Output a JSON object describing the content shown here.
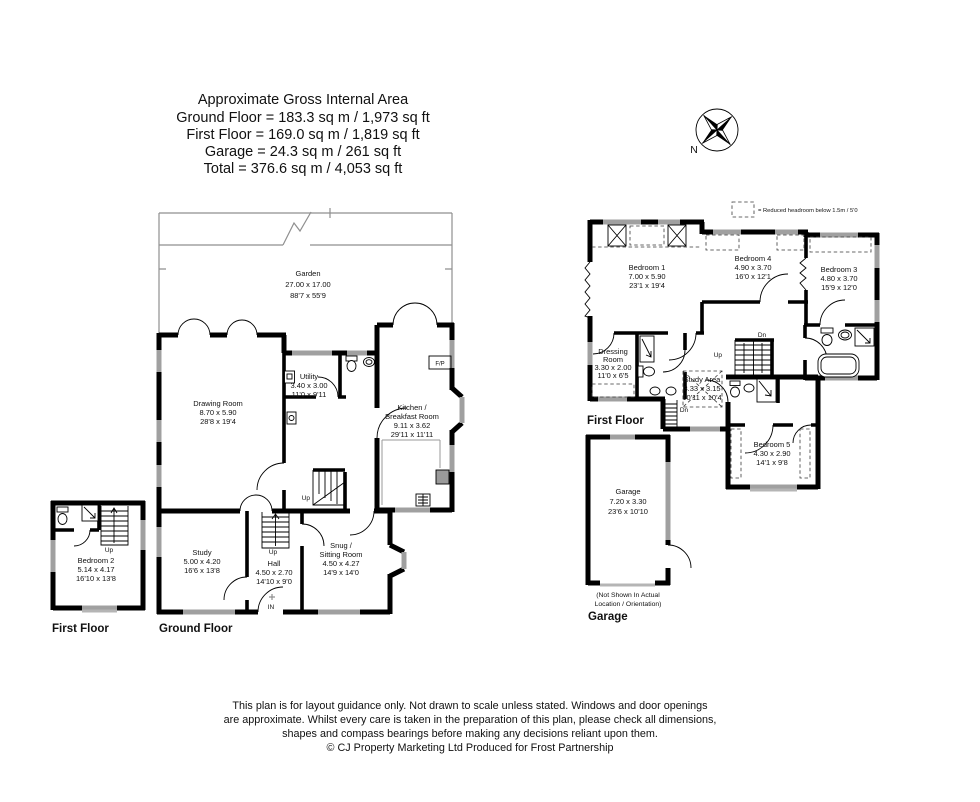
{
  "header": {
    "title": "Approximate Gross Internal Area",
    "lines": [
      "Ground Floor = 183.3 sq m / 1,973 sq ft",
      "First Floor = 169.0 sq m / 1,819 sq ft",
      "Garage = 24.3 sq m / 261 sq ft",
      "Total = 376.6 sq m / 4,053 sq ft"
    ]
  },
  "compass": {
    "north_label": "N"
  },
  "legend": {
    "note": "= Reduced headroom below 1.5m / 5'0"
  },
  "rooms": {
    "garden": {
      "name": "Garden",
      "metric": "27.00 x 17.00",
      "imperial": "88'7 x 55'9"
    },
    "drawing_room": {
      "name": "Drawing Room",
      "metric": "8.70 x 5.90",
      "imperial": "28'8 x 19'4"
    },
    "utility": {
      "name": "Utility",
      "metric": "3.40 x 3.00",
      "imperial": "11'0 x 9'11"
    },
    "kitchen": {
      "name1": "Kitchen /",
      "name2": "Breakfast Room",
      "metric": "9.11 x 3.62",
      "imperial": "29'11 x 11'11"
    },
    "study": {
      "name": "Study",
      "metric": "5.00 x 4.20",
      "imperial": "16'6 x 13'8"
    },
    "hall": {
      "name": "Hall",
      "metric": "4.50 x 2.70",
      "imperial": "14'10 x 9'0"
    },
    "snug": {
      "name1": "Snug /",
      "name2": "Sitting Room",
      "metric": "4.50 x 4.27",
      "imperial": "14'9 x 14'0"
    },
    "bedroom2": {
      "name": "Bedroom 2",
      "metric": "5.14 x 4.17",
      "imperial": "16'10 x 13'8"
    },
    "bedroom1": {
      "name": "Bedroom 1",
      "metric": "7.00 x 5.90",
      "imperial": "23'1 x 19'4"
    },
    "bedroom4": {
      "name": "Bedroom 4",
      "metric": "4.90 x 3.70",
      "imperial": "16'0 x 12'1"
    },
    "bedroom3": {
      "name": "Bedroom 3",
      "metric": "4.80 x 3.70",
      "imperial": "15'9 x 12'0"
    },
    "bedroom5": {
      "name": "Bedroom 5",
      "metric": "4.30 x 2.90",
      "imperial": "14'1 x 9'8"
    },
    "dressing": {
      "name1": "Dressing",
      "name2": "Room",
      "metric": "3.30 x 2.00",
      "imperial": "11'0 x 6'5"
    },
    "study_area": {
      "name": "Study Area",
      "metric": "3.33 x 3.15",
      "imperial": "10'11 x 10'4"
    },
    "garage": {
      "name": "Garage",
      "metric": "7.20 x 3.30",
      "imperial": "23'6 x 10'10"
    }
  },
  "labels": {
    "ground_floor": "Ground Floor",
    "first_floor": "First Floor",
    "garage": "Garage",
    "garage_note1": "(Not Shown In Actual",
    "garage_note2": "Location / Orientation)",
    "up": "Up",
    "dn": "Dn",
    "in": "IN",
    "fp": "F/P"
  },
  "footer": {
    "lines": [
      "This plan is for layout guidance only. Not drawn to scale unless stated. Windows and door openings",
      "are approximate. Whilst every care is taken in the preparation of this plan, please check all dimensions,",
      "shapes and compass bearings before making any decisions reliant upon them.",
      "© CJ Property Marketing Ltd Produced for Frost Partnership"
    ]
  },
  "colors": {
    "wall": "#000000",
    "window": "#a0a0a0",
    "garden_line": "#8f8f8f",
    "text": "#111111"
  }
}
